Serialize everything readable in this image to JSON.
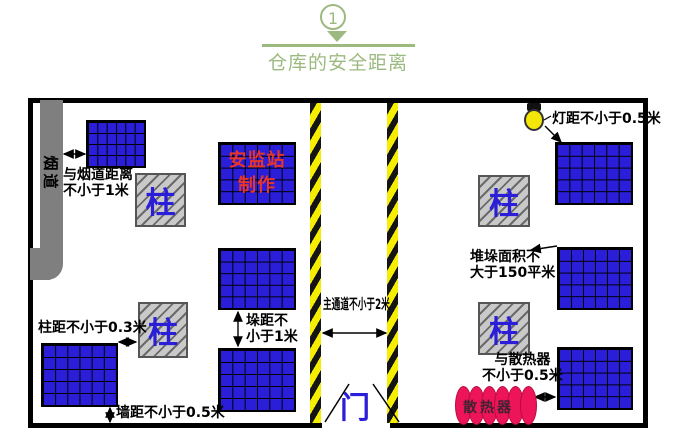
{
  "title": {
    "step": "1",
    "text": "仓库的安全距离"
  },
  "colors": {
    "accent_green": "#9cba7f",
    "stack_blue": "#2a1ed8",
    "stripe_yellow": "#f5ee00",
    "pillar_gray": "#c9c9c9",
    "flue_gray": "#7f7f7f",
    "radiator_crimson": "#ed1459",
    "maker_red": "#e8352a"
  },
  "diagram": {
    "flue": {
      "label": "烟道"
    },
    "pillar": {
      "label": "柱"
    },
    "maker_block": {
      "line1": "安监站",
      "line2": "制作"
    },
    "door": {
      "label": "门"
    },
    "radiator": {
      "label": "散热器"
    },
    "labels": {
      "flue_distance_line1": "与烟道距离",
      "flue_distance_line2": "不小于1米",
      "pillar_distance": "柱距不小于0.3米",
      "wall_distance": "墙距不小于0.5米",
      "stack_distance_line1": "垛距不",
      "stack_distance_line2": "小于1米",
      "main_aisle": "主通道不小于2米",
      "lamp_distance": "灯距不小于0.5米",
      "stack_area_line1": "堆垛面积不",
      "stack_area_line2": "大于150平米",
      "radiator_distance_line1": "与散热器",
      "radiator_distance_line2": "不小于0.5米"
    }
  }
}
